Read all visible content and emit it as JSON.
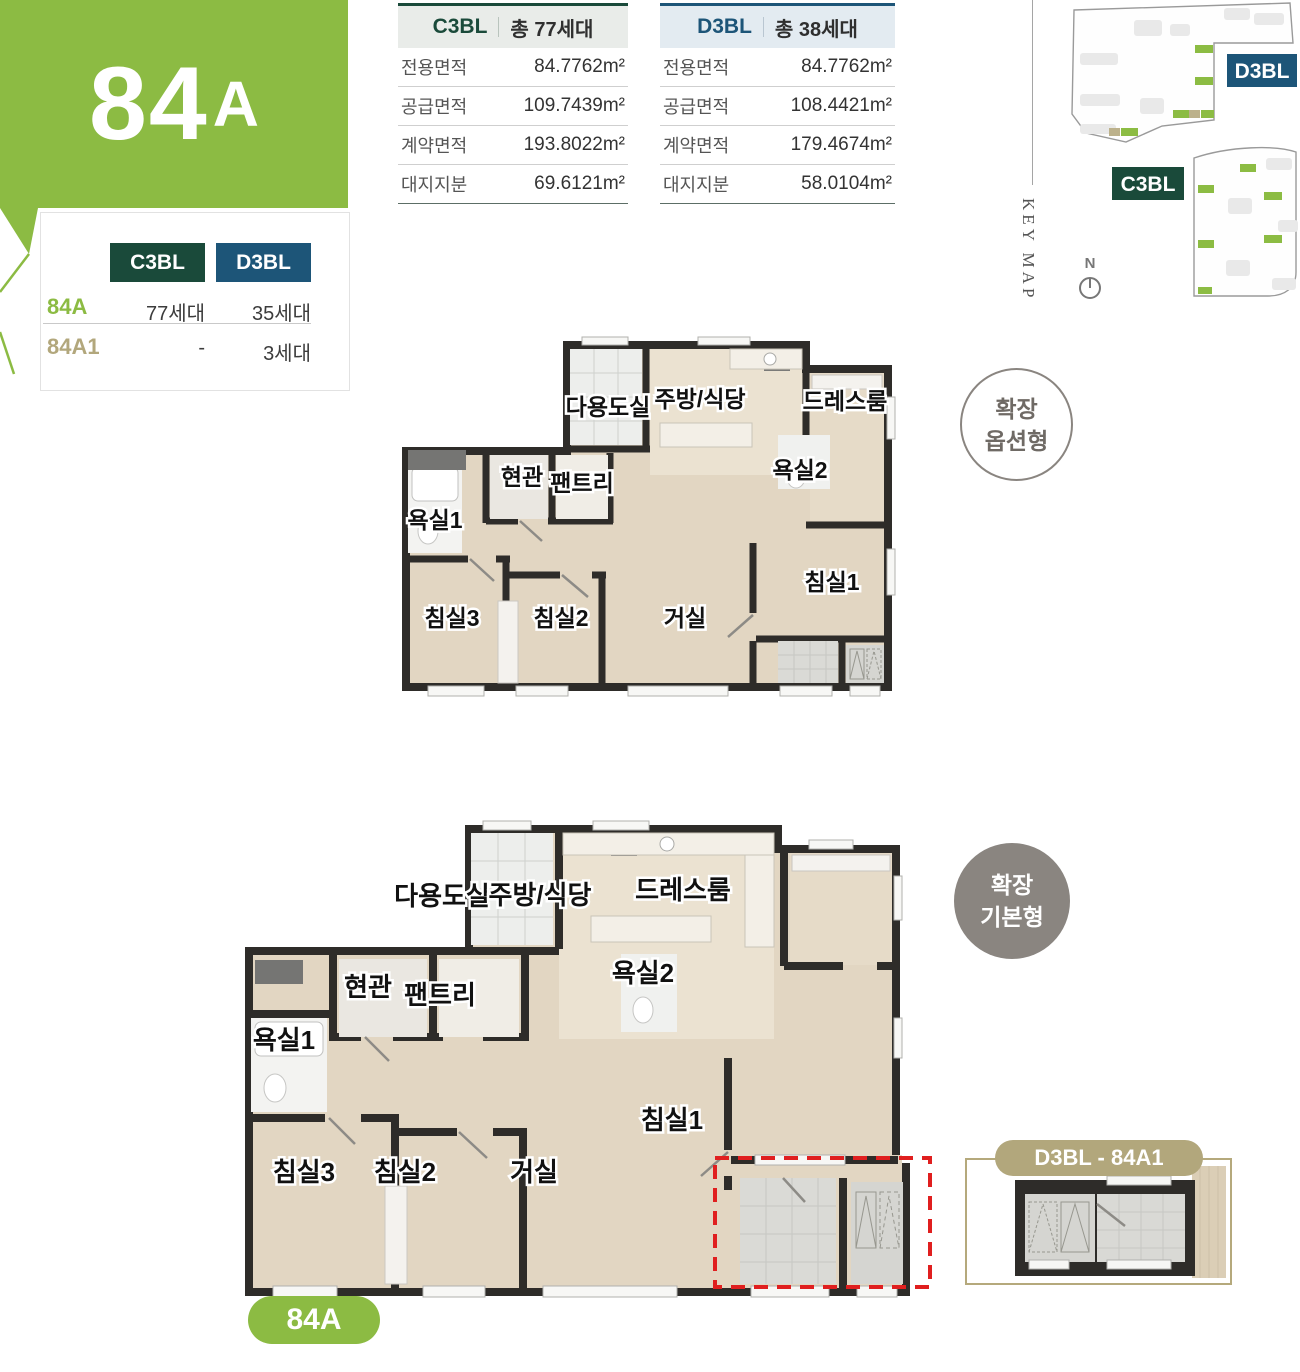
{
  "colors": {
    "brand_green": "#8cbb43",
    "dark_green": "#1a4a3a",
    "dark_blue": "#1d5578",
    "tan": "#b2a77c",
    "badge_gray": "#8a8580",
    "alert_red": "#e01f1f"
  },
  "unit_panel": {
    "big_number": "84",
    "big_suffix": "A",
    "columns": [
      "C3BL",
      "D3BL"
    ],
    "rows": [
      {
        "name": "84A",
        "v1": "77세대",
        "v2": "35세대"
      },
      {
        "name": "84A1",
        "v1": "-",
        "v2": "3세대"
      }
    ]
  },
  "spec_tables": [
    {
      "block": "C3BL",
      "total": "총 77세대",
      "rows": [
        {
          "label": "전용면적",
          "value": "84.7762m²"
        },
        {
          "label": "공급면적",
          "value": "109.7439m²"
        },
        {
          "label": "계약면적",
          "value": "193.8022m²"
        },
        {
          "label": "대지지분",
          "value": "69.6121m²"
        }
      ]
    },
    {
      "block": "D3BL",
      "total": "총 38세대",
      "rows": [
        {
          "label": "전용면적",
          "value": "84.7762m²"
        },
        {
          "label": "공급면적",
          "value": "108.4421m²"
        },
        {
          "label": "계약면적",
          "value": "179.4674m²"
        },
        {
          "label": "대지지분",
          "value": "58.0104m²"
        }
      ]
    }
  ],
  "key_map": {
    "title": "KEY MAP",
    "north_label": "N",
    "d3bl_label": "D3BL",
    "c3bl_label": "C3BL"
  },
  "plan_option": {
    "badge_line1": "확장",
    "badge_line2": "옵션형",
    "rooms": {
      "utility": "다용도실",
      "kitchen": "주방/식당",
      "dress": "드레스룸",
      "entrance": "현관",
      "pantry": "팬트리",
      "bath2": "욕실2",
      "bath1": "욕실1",
      "bed3": "침실3",
      "bed2": "침실2",
      "living": "거실",
      "bed1": "침실1"
    }
  },
  "plan_basic": {
    "badge_line1": "확장",
    "badge_line2": "기본형",
    "unit_pill": "84A",
    "sub_plan_label": "D3BL - 84A1",
    "rooms": {
      "utility": "다용도실",
      "kitchen": "주방/식당",
      "dress": "드레스룸",
      "entrance": "현관",
      "pantry": "팬트리",
      "bath2": "욕실2",
      "bath1": "욕실1",
      "bed3": "침실3",
      "bed2": "침실2",
      "living": "거실",
      "bed1": "침실1"
    }
  }
}
